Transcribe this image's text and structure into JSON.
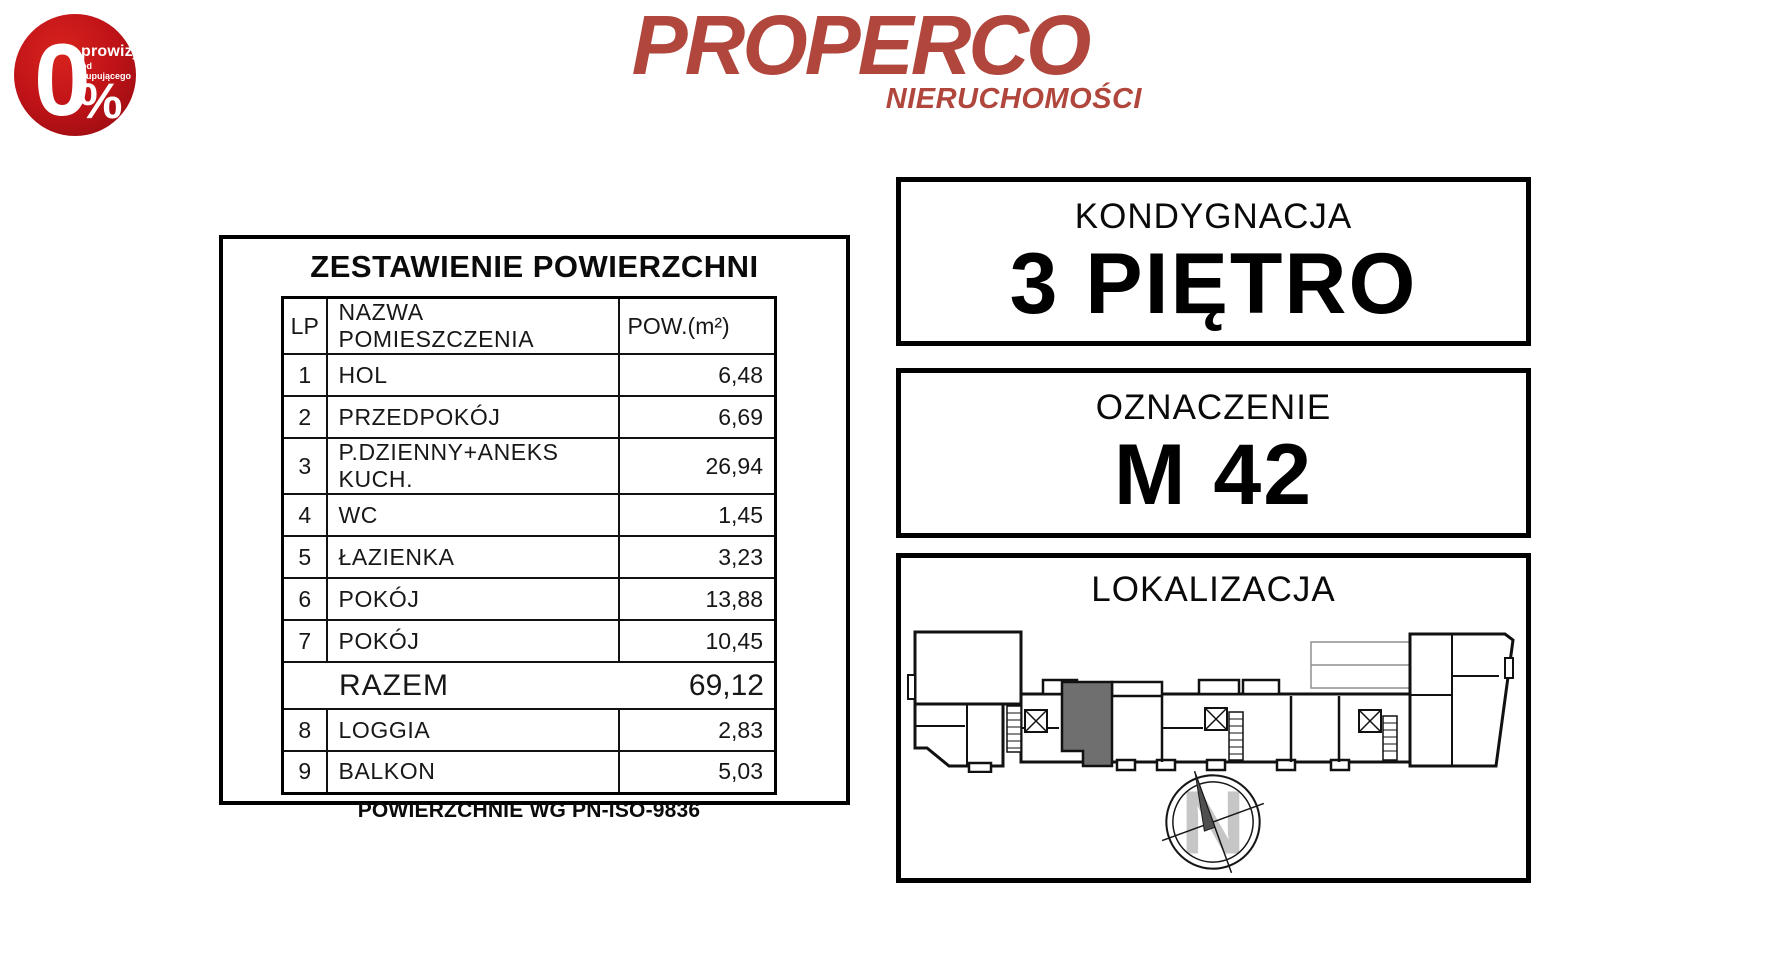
{
  "badge": {
    "zero": "0",
    "percent_sign": "%",
    "line1": "prowizji",
    "line2": "od kupującego"
  },
  "logo": {
    "name": "PROPERCO",
    "subtitle": "NIERUCHOMOŚCI",
    "color": "#b0463c"
  },
  "area_table": {
    "title": "ZESTAWIENIE POWIERZCHNI",
    "columns": {
      "lp": "LP",
      "name": "NAZWA POMIESZCZENIA",
      "area": "POW.(m²)"
    },
    "rows": [
      {
        "lp": "1",
        "name": "HOL",
        "area": "6,48"
      },
      {
        "lp": "2",
        "name": "PRZEDPOKÓJ",
        "area": "6,69"
      },
      {
        "lp": "3",
        "name": "P.DZIENNY+ANEKS KUCH.",
        "area": "26,94"
      },
      {
        "lp": "4",
        "name": "WC",
        "area": "1,45"
      },
      {
        "lp": "5",
        "name": "ŁAZIENKA",
        "area": "3,23"
      },
      {
        "lp": "6",
        "name": "POKÓJ",
        "area": "13,88"
      },
      {
        "lp": "7",
        "name": "POKÓJ",
        "area": "10,45"
      },
      {
        "lp": "8",
        "name": "LOGGIA",
        "area": "2,83"
      },
      {
        "lp": "9",
        "name": "BALKON",
        "area": "5,03"
      }
    ],
    "total": {
      "label": "RAZEM",
      "value": "69,12"
    },
    "footnote": "POWIERZCHNIE WG PN-ISO-9836"
  },
  "info_boxes": {
    "floor": {
      "label": "KONDYGNACJA",
      "value": "3 PIĘTRO"
    },
    "designation": {
      "label": "OZNACZENIE",
      "value": "M 42"
    },
    "location": {
      "label": "LOKALIZACJA"
    }
  },
  "compass": {
    "letter": "N"
  },
  "colors": {
    "logo_red": "#b0463c",
    "badge_red": "#c01318",
    "highlight_gray": "#6f6f6f",
    "line_black": "#111111"
  }
}
